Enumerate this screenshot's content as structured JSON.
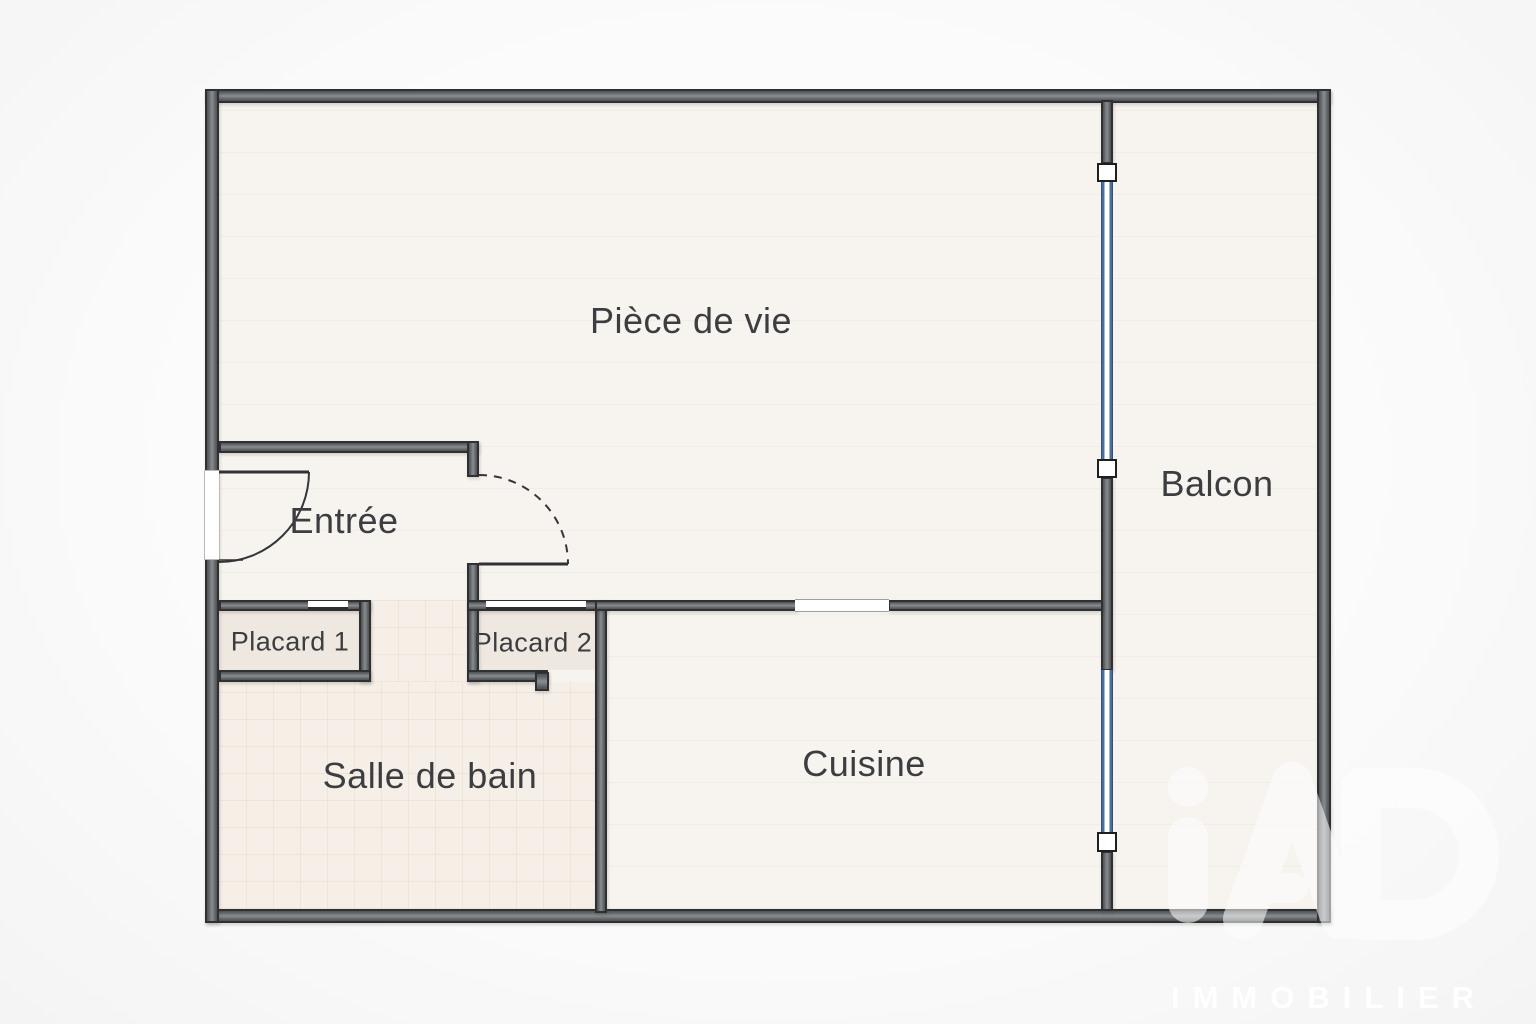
{
  "plan": {
    "title": "Plan d'appartement",
    "rooms": [
      {
        "id": "piece-de-vie",
        "label": "Pièce de vie"
      },
      {
        "id": "balcon",
        "label": "Balcon"
      },
      {
        "id": "entree",
        "label": "Entrée"
      },
      {
        "id": "placard-1",
        "label": "Placard 1"
      },
      {
        "id": "placard-2",
        "label": "Placard 2"
      },
      {
        "id": "salle-de-bain",
        "label": "Salle de bain"
      },
      {
        "id": "cuisine",
        "label": "Cuisine"
      }
    ]
  },
  "watermark": {
    "brand": "iAD",
    "subtitle": "IMMOBILIER"
  },
  "colors": {
    "wall_fill": "#55585b",
    "wall_light": "#8a8d90",
    "wall_edge": "#2e3032",
    "floor": "#f7f3ee",
    "floor_tile": "#f5efe8",
    "placard": "#efe8e0",
    "window_blue": "#48709f",
    "label": "#3c3d40",
    "watermark_white": "#ffffff"
  }
}
